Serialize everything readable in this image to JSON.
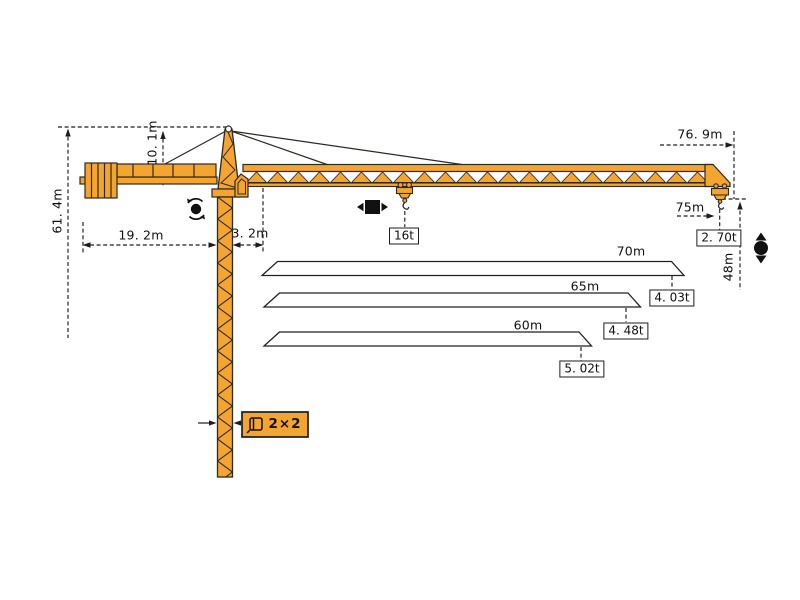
{
  "diagram_title": "tower-crane-dimension-and-load-diagram",
  "colors": {
    "crane_body": "#F4A52F",
    "outline": "#2d2a24",
    "dimension_lines": "#1d1d1d",
    "chart_bar_fill": "#ffffff"
  },
  "dims": {
    "total_height": "61. 4m",
    "head_height": "10. 1m",
    "counter_jib": "19. 2m",
    "jib_root": "3. 2m",
    "max_radius": "76. 9m",
    "tip_radius": "75m",
    "hook_height": "48m",
    "max_load": "16t",
    "tip_load": "2. 70t",
    "mast_section": "2×2"
  },
  "load_chart": {
    "rows": [
      {
        "length": "70m",
        "tip_load": "4. 03t"
      },
      {
        "length": "65m",
        "tip_load": "4. 48t"
      },
      {
        "length": "60m",
        "tip_load": "5. 02t"
      }
    ]
  },
  "icons": {
    "slew": "slew-rotation-icon",
    "trolley": "trolley-travel-icon",
    "hoist": "hoist-up-down-icon",
    "mast_section": "mast-cross-section-icon"
  }
}
